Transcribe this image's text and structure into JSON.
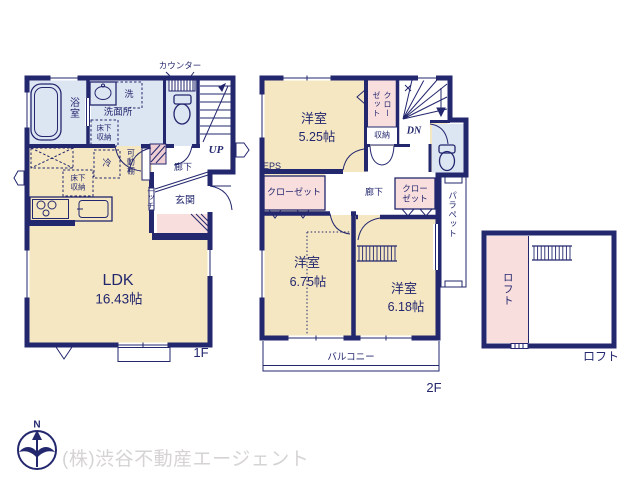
{
  "colors": {
    "wall_navy": "#23276e",
    "room_cream": "#f5e7c2",
    "wet_area_blue": "#dce5f2",
    "closet_pink": "#f9dede",
    "hatch_pink": "#eecdd3",
    "footer_text_gray": "#d6d3d3"
  },
  "floor1": {
    "floor_label": "1F",
    "labels": {
      "counter": "カウンター",
      "bath": "浴室",
      "washer": "洗",
      "washroom": "洗面所",
      "underfloor_storage_washroom": "床下収納",
      "fridge": "冷",
      "movable_shelf": "可動棚",
      "underfloor_storage_kitchen": "床下収納",
      "hallway": "廊下",
      "stairs_up": "UP",
      "niche": "ニッチ",
      "entrance": "玄関",
      "ldk_name": "LDK",
      "ldk_size": "16.43帖"
    }
  },
  "floor2": {
    "floor_label": "2F",
    "labels": {
      "bedroom1_name": "洋室",
      "bedroom1_size": "5.25帖",
      "closet_top": "クローゼット",
      "storage": "収納",
      "stairs_down": "DN",
      "eps": "EPS",
      "closet_left": "クローゼット",
      "hallway": "廊下",
      "closet_right": "クローゼット",
      "parapet": "パラペット",
      "bedroom2_name": "洋室",
      "bedroom2_size": "6.75帖",
      "bedroom3_name": "洋室",
      "bedroom3_size": "6.18帖",
      "balcony": "バルコニー"
    }
  },
  "loft": {
    "floor_label": "ロフト",
    "labels": {
      "loft_room": "ロフト"
    }
  },
  "footer": {
    "compass_north": "N",
    "company": "(株)渋谷不動産エージェント"
  }
}
